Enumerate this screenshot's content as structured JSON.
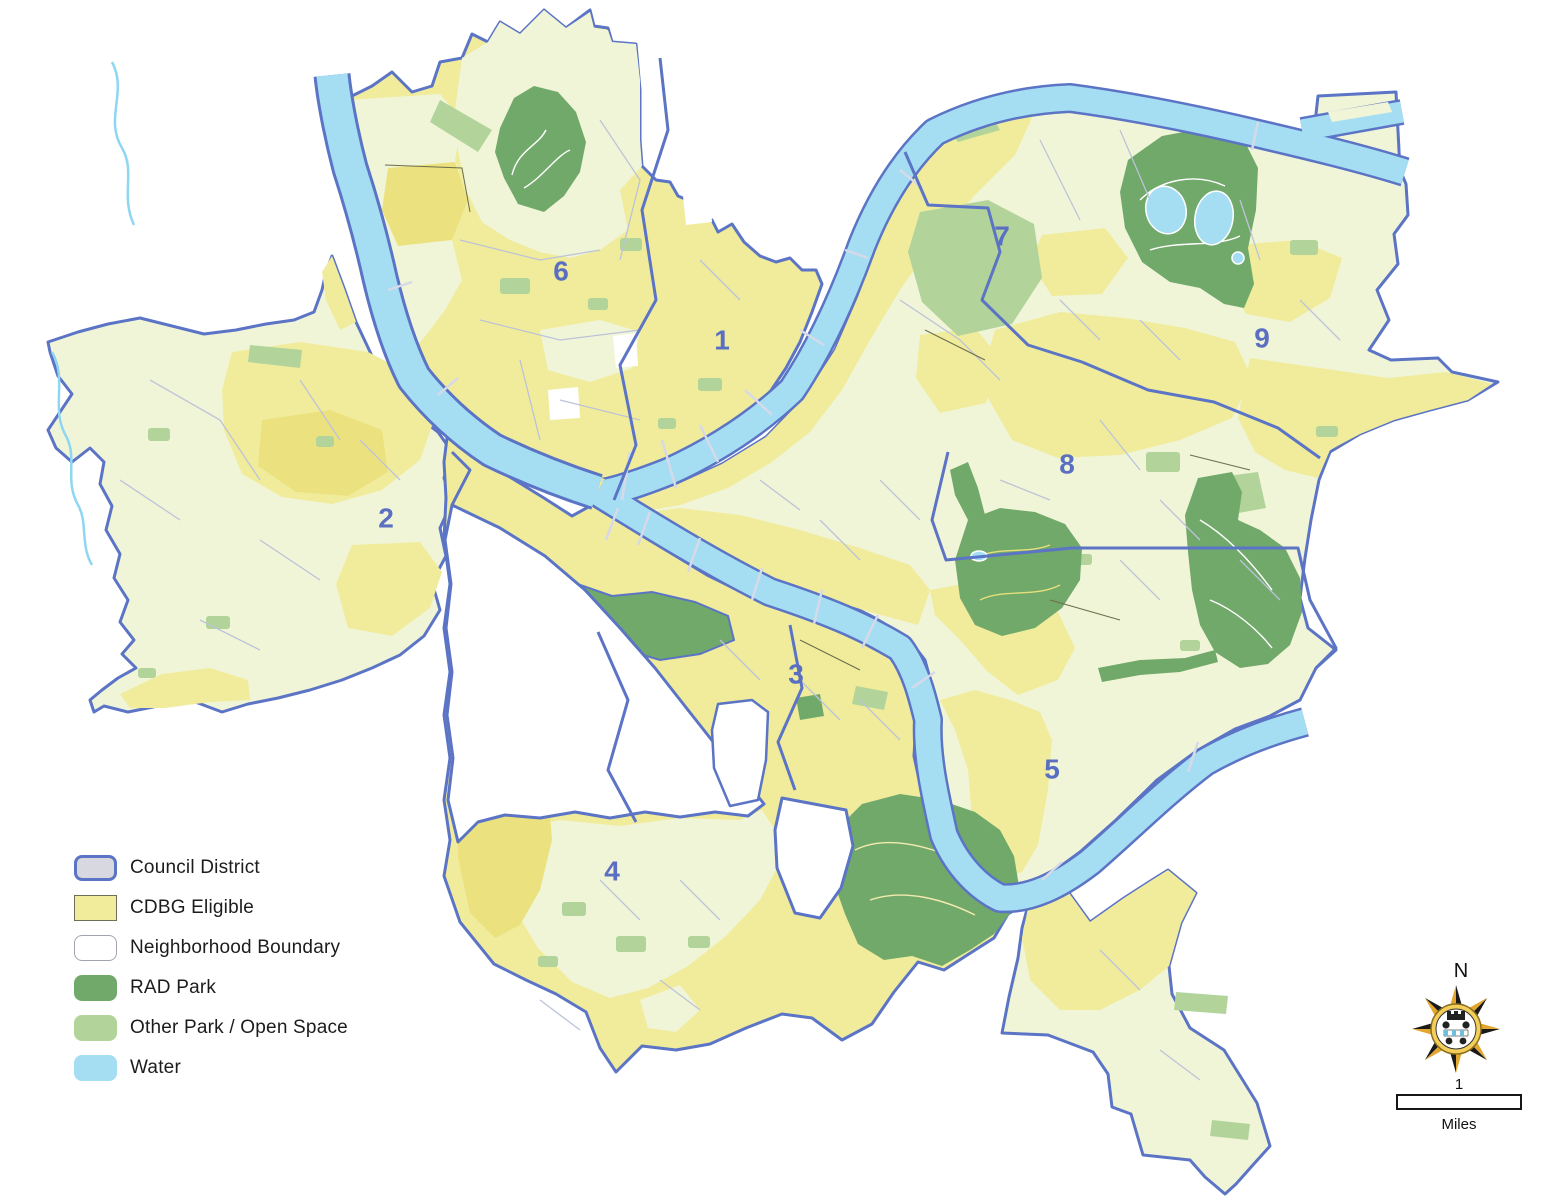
{
  "legend": {
    "items": [
      {
        "label": "Council District",
        "fill": "#d8d8e0",
        "border": "#5b74c5",
        "border_width": 3,
        "rounded": true
      },
      {
        "label": "CDBG Eligible",
        "fill": "#f0ec9c",
        "border": "#6f6f58",
        "border_width": 1.5,
        "rounded": false
      },
      {
        "label": "Neighborhood Boundary",
        "fill": "#ffffff",
        "border": "#a0a5ad",
        "border_width": 1.5,
        "rounded": true
      },
      {
        "label": "RAD Park",
        "fill": "#71a96a",
        "border": "#71a96a",
        "border_width": 0,
        "rounded": true
      },
      {
        "label": "Other Park / Open Space",
        "fill": "#b2d49a",
        "border": "#b2d49a",
        "border_width": 0,
        "rounded": true
      },
      {
        "label": "Water",
        "fill": "#a5def3",
        "border": "#a5def3",
        "border_width": 0,
        "rounded": true
      }
    ]
  },
  "map": {
    "district_labels": [
      {
        "label": "1",
        "x": 722,
        "y": 340
      },
      {
        "label": "2",
        "x": 386,
        "y": 518
      },
      {
        "label": "3",
        "x": 796,
        "y": 674
      },
      {
        "label": "4",
        "x": 612,
        "y": 871
      },
      {
        "label": "5",
        "x": 1052,
        "y": 769
      },
      {
        "label": "6",
        "x": 561,
        "y": 271
      },
      {
        "label": "7",
        "x": 1002,
        "y": 236
      },
      {
        "label": "8",
        "x": 1067,
        "y": 464
      },
      {
        "label": "9",
        "x": 1262,
        "y": 338
      }
    ]
  },
  "compass": {
    "north_label": "N"
  },
  "scale_bar": {
    "value_label": "1",
    "unit_label": "Miles"
  },
  "colors": {
    "cdbg_yellow": "#f0ec9c",
    "cdbg_yellow_strong": "#ebe27f",
    "neighborhood_cream": "#f1f5d8",
    "rad_park_green": "#71a96a",
    "other_park_green": "#b2d49a",
    "water_blue": "#a5def3",
    "council_boundary_blue": "#5b74c5",
    "district_label_blue": "#5a6fc1",
    "neighborhood_line": "#bcc3d8",
    "tract_line": "#6d6d4a"
  }
}
